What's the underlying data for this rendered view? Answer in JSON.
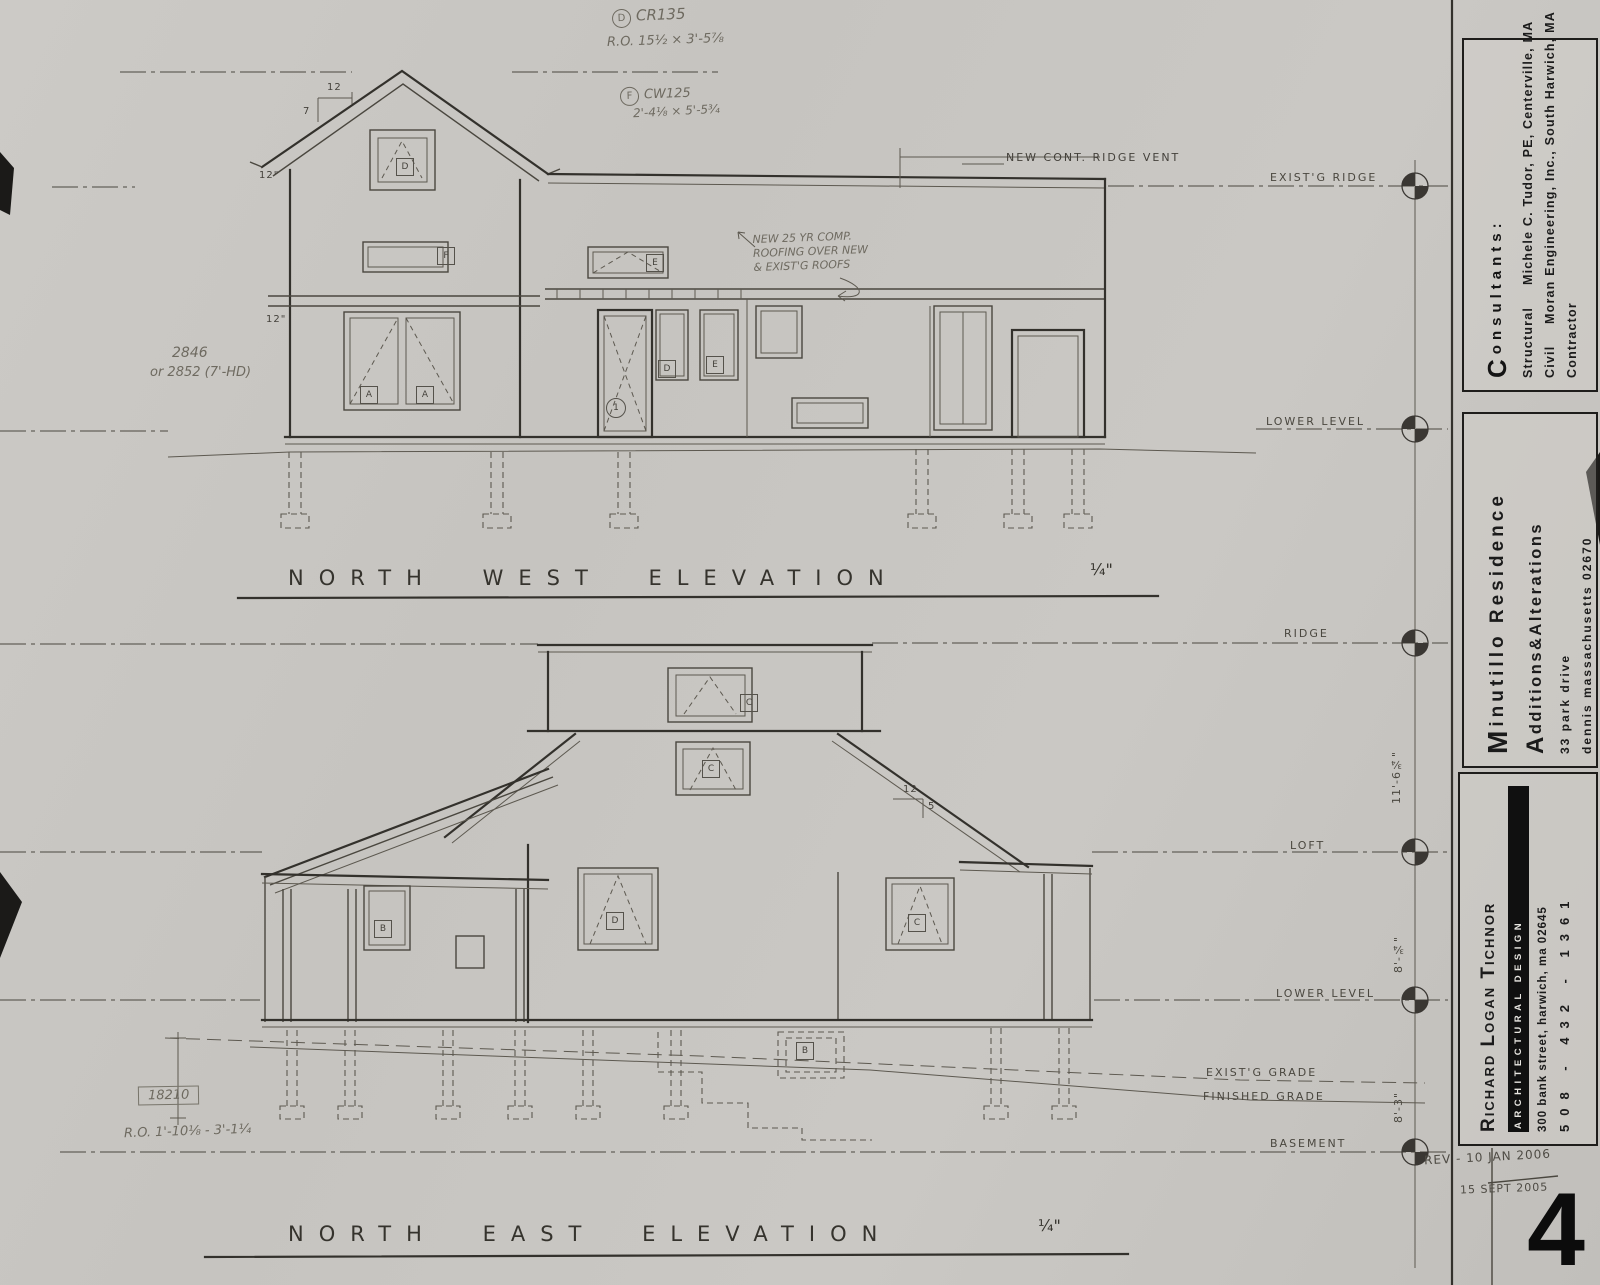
{
  "sheet": {
    "number": "4",
    "revision1": "REV - 10 JAN 2006",
    "revision2": "15 SEPT 2005"
  },
  "titleblock": {
    "consultants_heading": "Consultants:",
    "structural_label": "Structural",
    "structural_value": "Michele C. Tudor, PE, Centerville, MA",
    "civil_label": "Civil",
    "civil_value": "Moran Engineering, Inc., South Harwich, MA",
    "contractor_label": "Contractor",
    "project_name": "Minutillo Residence",
    "project_subtitle": "Additions&Alterations",
    "project_address1": "33 park drive",
    "project_address2": "dennis massachusetts 02670",
    "architect_name": "Richard Logan Tichnor",
    "architect_firm": "Architectural Design",
    "architect_address": "300 bank street, harwich, ma 02645",
    "architect_phone": "508 - 432 - 1361"
  },
  "titles": {
    "nw": "NORTH WEST ELEVATION",
    "nw_scale": "¼\"",
    "ne": "NORTH EAST ELEVATION",
    "ne_scale": "¼\""
  },
  "levels": {
    "exist_ridge": "EXIST'G RIDGE",
    "lower_nw": "LOWER LEVEL",
    "ridge": "RIDGE",
    "loft": "LOFT",
    "lower_ne": "LOWER LEVEL",
    "exist_grade": "EXIST'G GRADE",
    "fin_grade": "FINISHED GRADE",
    "basement": "BASEMENT"
  },
  "dims": {
    "ridge_loft": "11'-6¾\"",
    "loft_lower": "8'-¾\"",
    "lower_basement": "8'-3\"",
    "pitch_run_nw": "12",
    "pitch_rise_nw": "7",
    "pitch_run_ne": "12",
    "pitch_rise_ne": "5",
    "eave_overhang": "12\"",
    "belt_offset": "12\""
  },
  "notes": {
    "cr_ref": "D",
    "cr_text": "CR135",
    "cr_size": "R.O. 15½ × 3'-5⅞",
    "cw_ref": "F",
    "cw_text": "CW125",
    "cw_size": "2'-4⅛ × 5'-5¾",
    "ridge_vent": "NEW CONT. RIDGE VENT",
    "roofing1": "NEW 25 YR COMP.",
    "roofing2": "ROOFING OVER NEW",
    "roofing3": "& EXIST'G ROOFS",
    "win_alt1": "2846",
    "win_alt2": "or 2852 (7'-HD)",
    "door_ref": "18210",
    "door_ro": "R.O. 1'-10⅛ - 3'-1¼"
  },
  "labels": [
    "D",
    "F",
    "A",
    "A",
    "E",
    "1",
    "D",
    "E",
    "C",
    "C",
    "D",
    "B",
    "C",
    "B"
  ],
  "palette": {
    "paper": "#c8c6c2",
    "pencil_light": "#6e6a60",
    "pencil": "#45423c",
    "ink": "#141414"
  }
}
